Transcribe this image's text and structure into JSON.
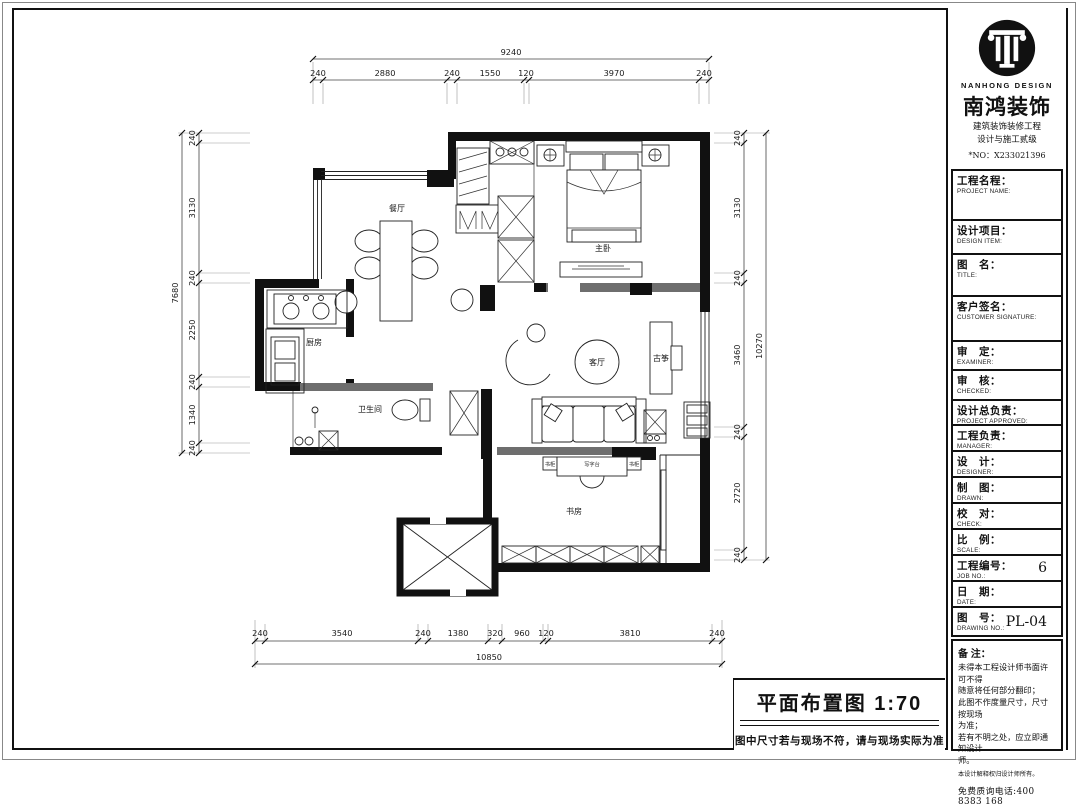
{
  "sheet": {
    "plan_title": "平面布置图  1:70",
    "plan_note": "图中尺寸若与现场不符，请与现场实际为准"
  },
  "company": {
    "logo_en": "NANHONG DESIGN",
    "name": "南鸿装饰",
    "line1": "建筑装饰装修工程",
    "line2": "设计与施工贰级",
    "no_line": "*NO：X233021396"
  },
  "title_block": {
    "fields": [
      {
        "cn": "工程名程：",
        "en": "PROJECT NAME:",
        "value": ""
      },
      {
        "cn": "设计项目：",
        "en": "DESIGN ITEM:",
        "value": ""
      },
      {
        "cn": "图　名：",
        "en": "TITLE:",
        "value": ""
      },
      {
        "cn": "客户签名：",
        "en": "CUSTOMER SIGNATURE:",
        "value": ""
      },
      {
        "cn": "审　定：",
        "en": "EXAMINER:",
        "value": ""
      },
      {
        "cn": "审　核：",
        "en": "CHECKED:",
        "value": ""
      },
      {
        "cn": "设计总负责：",
        "en": "PROJECT APPROVED:",
        "value": ""
      },
      {
        "cn": "工程负责：",
        "en": "MANAGER:",
        "value": ""
      },
      {
        "cn": "设　计：",
        "en": "DESIGNER:",
        "value": ""
      },
      {
        "cn": "制　图：",
        "en": "DRAWN:",
        "value": ""
      },
      {
        "cn": "校　对：",
        "en": "CHECK:",
        "value": ""
      },
      {
        "cn": "比　例：",
        "en": "SCALE:",
        "value": ""
      },
      {
        "cn": "工程编号：",
        "en": "JOB NO.:",
        "value": "6"
      },
      {
        "cn": "日　期：",
        "en": "DATE:",
        "value": ""
      },
      {
        "cn": "图　号：",
        "en": "DRAWING NO.:",
        "value": "PL-04"
      }
    ],
    "remark_title": "备 注：",
    "remarks": [
      "未得本工程设计师书面许可不得",
      "随意将任何部分翻印；",
      "此图不作度量尺寸，尺寸按现场",
      "为准；",
      "若有不明之处，应立即通知设计",
      "师。"
    ],
    "remark_small": "本设计解释权归设计师所有。",
    "hotline": "免费质询电话:400 8383 168"
  },
  "rooms": {
    "dining": "餐厅",
    "master_bedroom": "主卧",
    "kitchen": "厨房",
    "bathroom": "卫生间",
    "living": "客厅",
    "guzheng": "古筝",
    "study": "书房",
    "desk": "写字台",
    "bookcase_left": "书柜",
    "bookcase_right": "书柜"
  },
  "dims": {
    "top": {
      "total": "9240",
      "segments": [
        "240",
        "2880",
        "240",
        "1550",
        "120",
        "3970",
        "240"
      ]
    },
    "bottom": {
      "total": "10850",
      "segments": [
        "240",
        "3540",
        "240",
        "1380",
        "320",
        "960",
        "120",
        "3810",
        "240"
      ]
    },
    "left": {
      "total": "7680",
      "segments": [
        "240",
        "3130",
        "240",
        "2250",
        "240",
        "1340",
        "240"
      ]
    },
    "right": {
      "total": "10270",
      "segments": [
        "240",
        "3130",
        "240",
        "3460",
        "240",
        "2720",
        "240"
      ]
    }
  },
  "colors": {
    "line": "#111111",
    "hatch_wall": "#6e6e6e",
    "background": "#ffffff"
  }
}
